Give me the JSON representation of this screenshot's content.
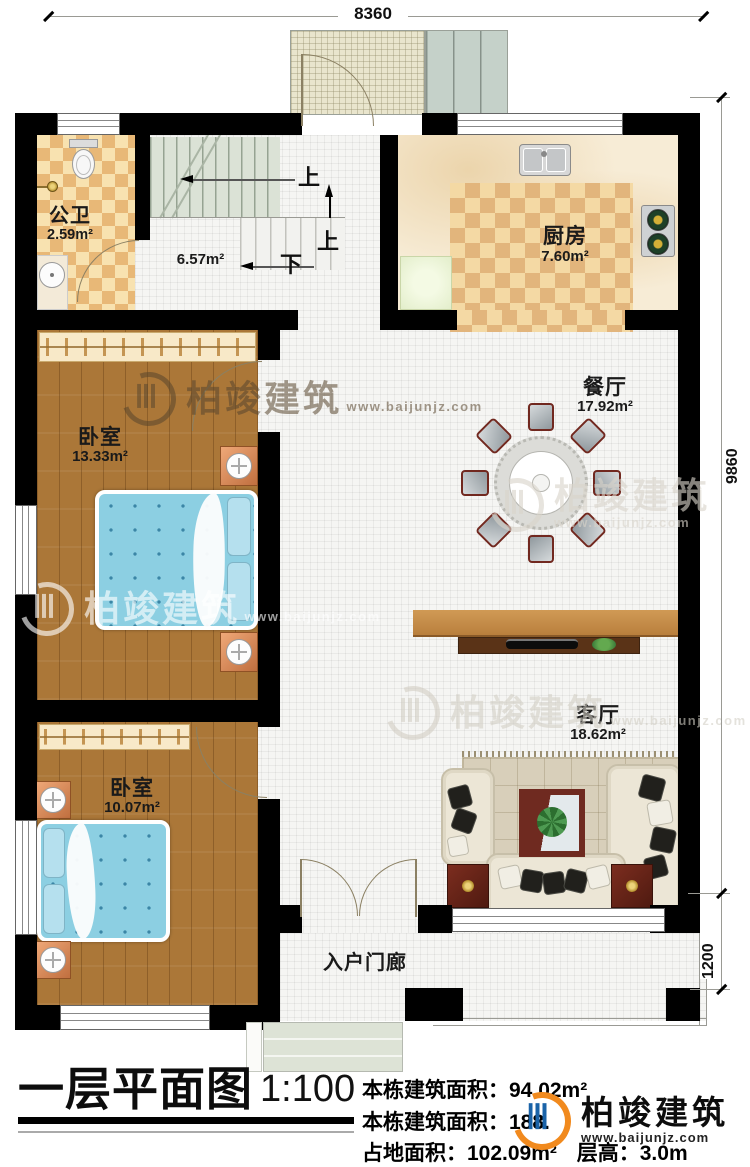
{
  "dimensions": {
    "top_width": "8360",
    "right_height": "9860",
    "porch_depth": "1200"
  },
  "rooms": {
    "bathroom": {
      "name": "公卫",
      "area": "2.59m²"
    },
    "stairwell": {
      "area": "6.57m²"
    },
    "kitchen": {
      "name": "厨房",
      "area": "7.60m²"
    },
    "dining": {
      "name": "餐厅",
      "area": "17.92m²"
    },
    "bedroom_upper": {
      "name": "卧室",
      "area": "13.33m²"
    },
    "bedroom_lower": {
      "name": "卧室",
      "area": "10.07m²"
    },
    "living": {
      "name": "客厅",
      "area": "18.62m²"
    },
    "entry_porch": {
      "name": "入户门廊"
    }
  },
  "stairs": {
    "up1": "上",
    "up2": "上",
    "down": "下"
  },
  "watermark": {
    "name": "柏竣建筑",
    "url": "www.baijunjz.com"
  },
  "brand": {
    "name": "柏竣建筑",
    "url": "www.baijunjz.com"
  },
  "footer": {
    "title": "一层平面图",
    "scale": "1:100",
    "line1_label": "本栋建筑面积：",
    "line1_value": "94.02m²",
    "line2_label": "本栋建筑面积：",
    "line2_value": "188.",
    "line3a_label": "占地面积：",
    "line3a_value": "102.09m²",
    "line3b_label": "层高：",
    "line3b_value": "3.0m"
  },
  "colors": {
    "wall": "#000000",
    "logo_orange": "#f18a1e",
    "logo_blue": "#1a63a8",
    "bed_blue": "#8ccfe2",
    "floor_wood": "#ab7738",
    "tile_accent": "#e8b877"
  }
}
